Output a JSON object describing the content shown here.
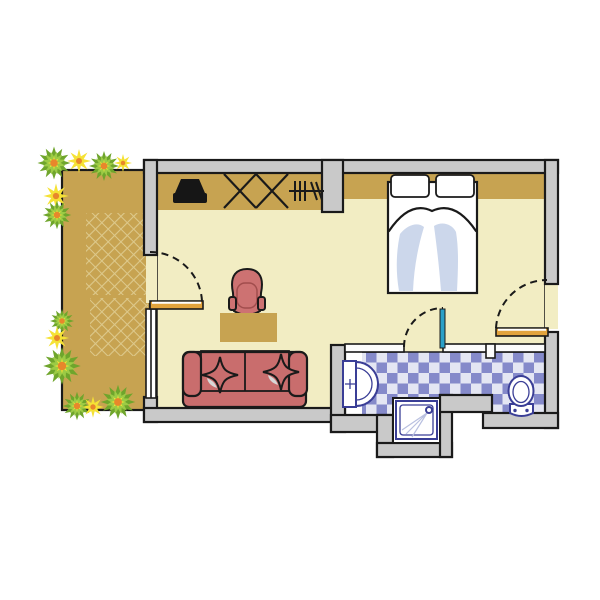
{
  "floorplan": {
    "type": "hotel-room-floor-plan",
    "rooms": [
      {
        "name": "terrace"
      },
      {
        "name": "living-sleeping-room"
      },
      {
        "name": "bathroom"
      }
    ],
    "elements": [
      "terrace-planting",
      "terrace-paving-hatch",
      "terrace-door",
      "window",
      "tv",
      "wardrobe-crosses",
      "clothes-rail",
      "double-bed",
      "pillows",
      "armchair",
      "desk",
      "sofa",
      "star-cushions",
      "bathroom-door",
      "entrance-door",
      "washbasin",
      "shower",
      "toilet",
      "checker-tile-floor"
    ],
    "colors": {
      "outline": "#1a1a1a",
      "wall": "#c9c9c9",
      "thinWall": "#fbfbfb",
      "floor": "#f2edc3",
      "terrace": "#c7a351",
      "hatch": "#ddc98c",
      "shelf": "#c7a351",
      "desk": "#c7a351",
      "sofa": "#c96d6d",
      "sofaShine": "#d8d8d8",
      "chair": "#cd7272",
      "tv": "#161616",
      "bedShadow": "#ccd7eb",
      "checkerDark": "#858aca",
      "checkerLight": "#e4e6f3",
      "fixture": "#3a3e96",
      "spray": "#b9c0e0",
      "doorOrange": "#e2a33c",
      "doorTeal": "#2ba0c8",
      "bushDark": "#6fa52c",
      "bushLight": "#9ccb45",
      "flowerYellow": "#f5e235",
      "flowerOrange": "#e8872b",
      "background": "#ffffff"
    }
  }
}
